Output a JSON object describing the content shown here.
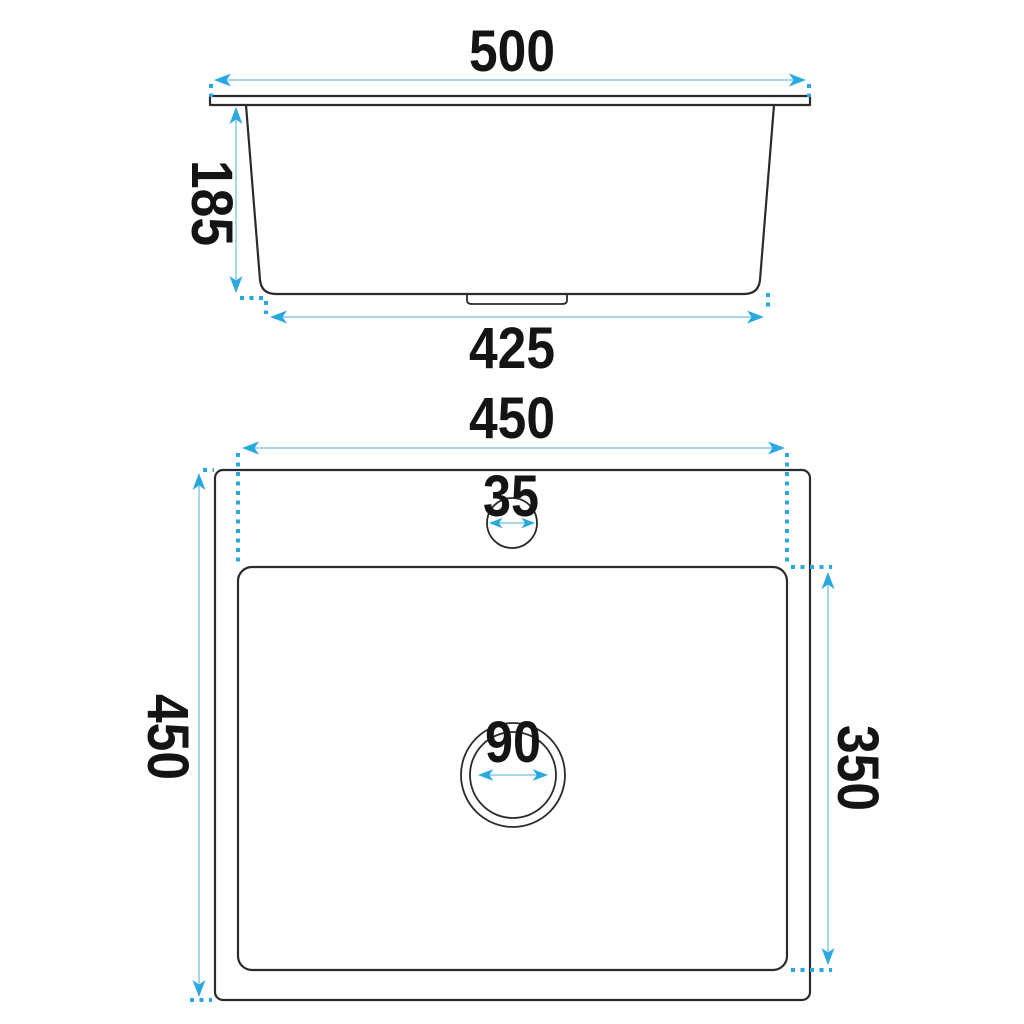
{
  "side_view": {
    "overall_width": "500",
    "depth": "185",
    "base_width": "425"
  },
  "plan_view": {
    "bowl_width": "450",
    "overall_length": "450",
    "bowl_length": "350",
    "tap_hole_diameter": "35",
    "drain_diameter": "90"
  },
  "colors": {
    "outline": "#2b2b2b",
    "dim_line": "#a6d6ec",
    "dim_accent": "#29a8df",
    "label": "#141414",
    "background": "#ffffff"
  }
}
